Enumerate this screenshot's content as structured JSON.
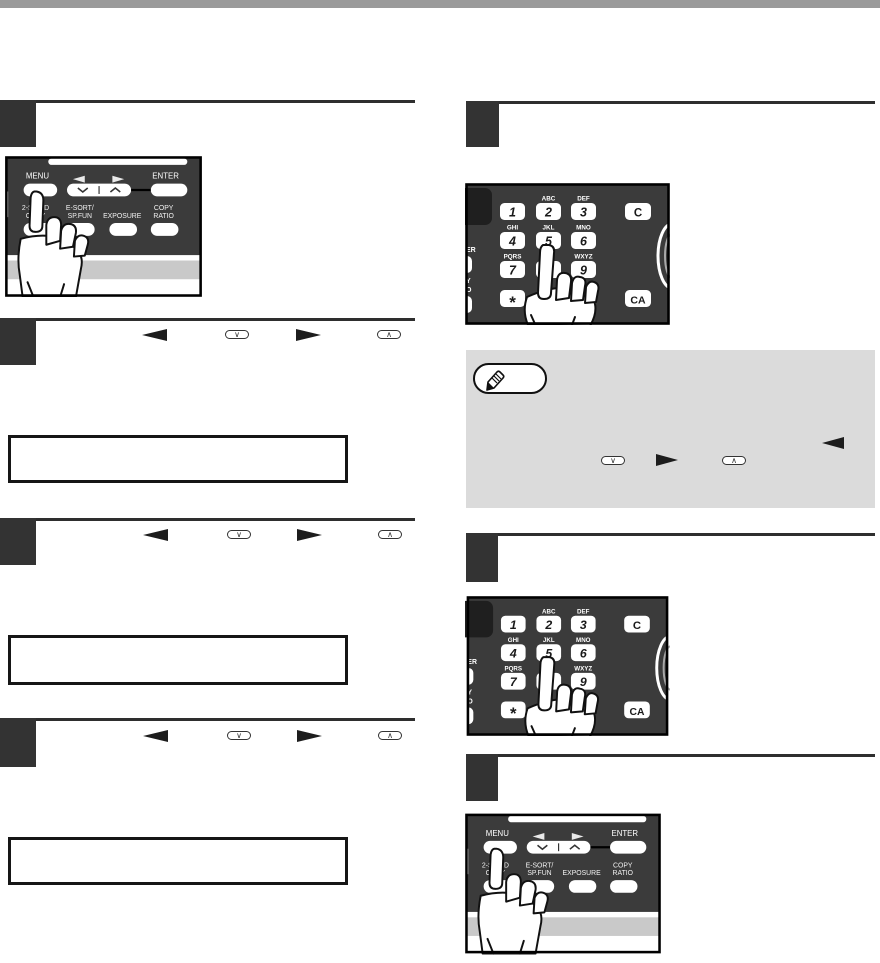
{
  "page": {
    "top_bar_color": "#9a9a9a",
    "step_box_color": "#333333",
    "note_bg_color": "#dbdbdb"
  },
  "panel": {
    "menu": "MENU",
    "enter": "ENTER",
    "two_sided_1": "2-SIDED",
    "two_sided_2": "COPY",
    "esort_1": "E-SORT/",
    "esort_2": "SP.FUN",
    "exposure": "EXPOSURE",
    "copy_ratio_1": "COPY",
    "copy_ratio_2": "RATIO"
  },
  "keypad": {
    "d1": "1",
    "d2": "2",
    "d3": "3",
    "d4": "4",
    "d5": "5",
    "d6": "6",
    "d7": "7",
    "d9": "9",
    "abc": "ABC",
    "def": "DEF",
    "ghi": "GHI",
    "jkl": "JKL",
    "mno": "MNO",
    "pqrs": "PQRS",
    "wxyz": "WXYZ",
    "at_label": "@.-_",
    "star": "*",
    "hash": "#",
    "clear": "C",
    "clear_all": "CA",
    "edge_er": "ER",
    "edge_y": "Y",
    "edge_o": "O"
  },
  "nav_icons": {
    "down": "∨",
    "up": "∧"
  }
}
